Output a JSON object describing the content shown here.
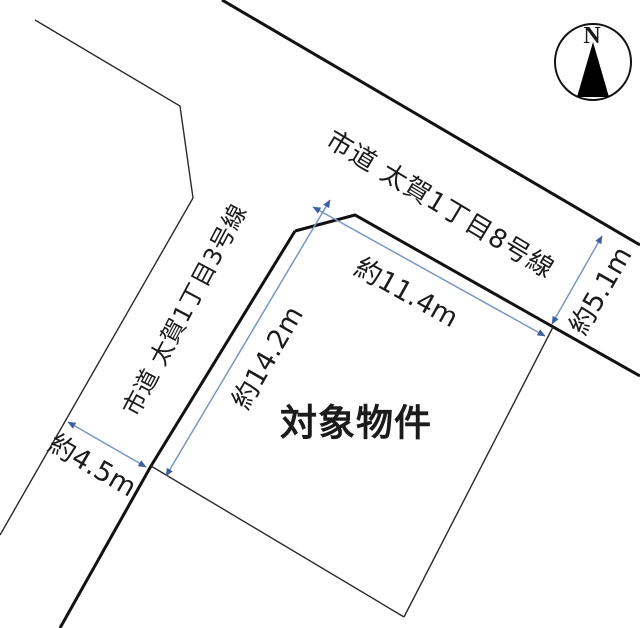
{
  "diagram": {
    "type": "land-plot-sketch",
    "compass": {
      "label": "N"
    },
    "roads": [
      {
        "id": "road-8",
        "label": "市道 太賀1丁目8号線"
      },
      {
        "id": "road-3",
        "label": "市道 太賀1丁目3号線"
      }
    ],
    "parcel": {
      "label": "対象物件"
    },
    "dimensions": [
      {
        "id": "top-frontage",
        "label": "約11.4m"
      },
      {
        "id": "left-frontage",
        "label": "約14.2m"
      },
      {
        "id": "right-side",
        "label": "約5.1m"
      },
      {
        "id": "road-width",
        "label": "約4.5m"
      }
    ],
    "colors": {
      "background": "#ffffff",
      "boundary_line": "#1b1b1b",
      "dimension_line": "#7a95c6",
      "dimension_arrow": "#3d5fa0",
      "compass_needle": "#000000"
    }
  }
}
